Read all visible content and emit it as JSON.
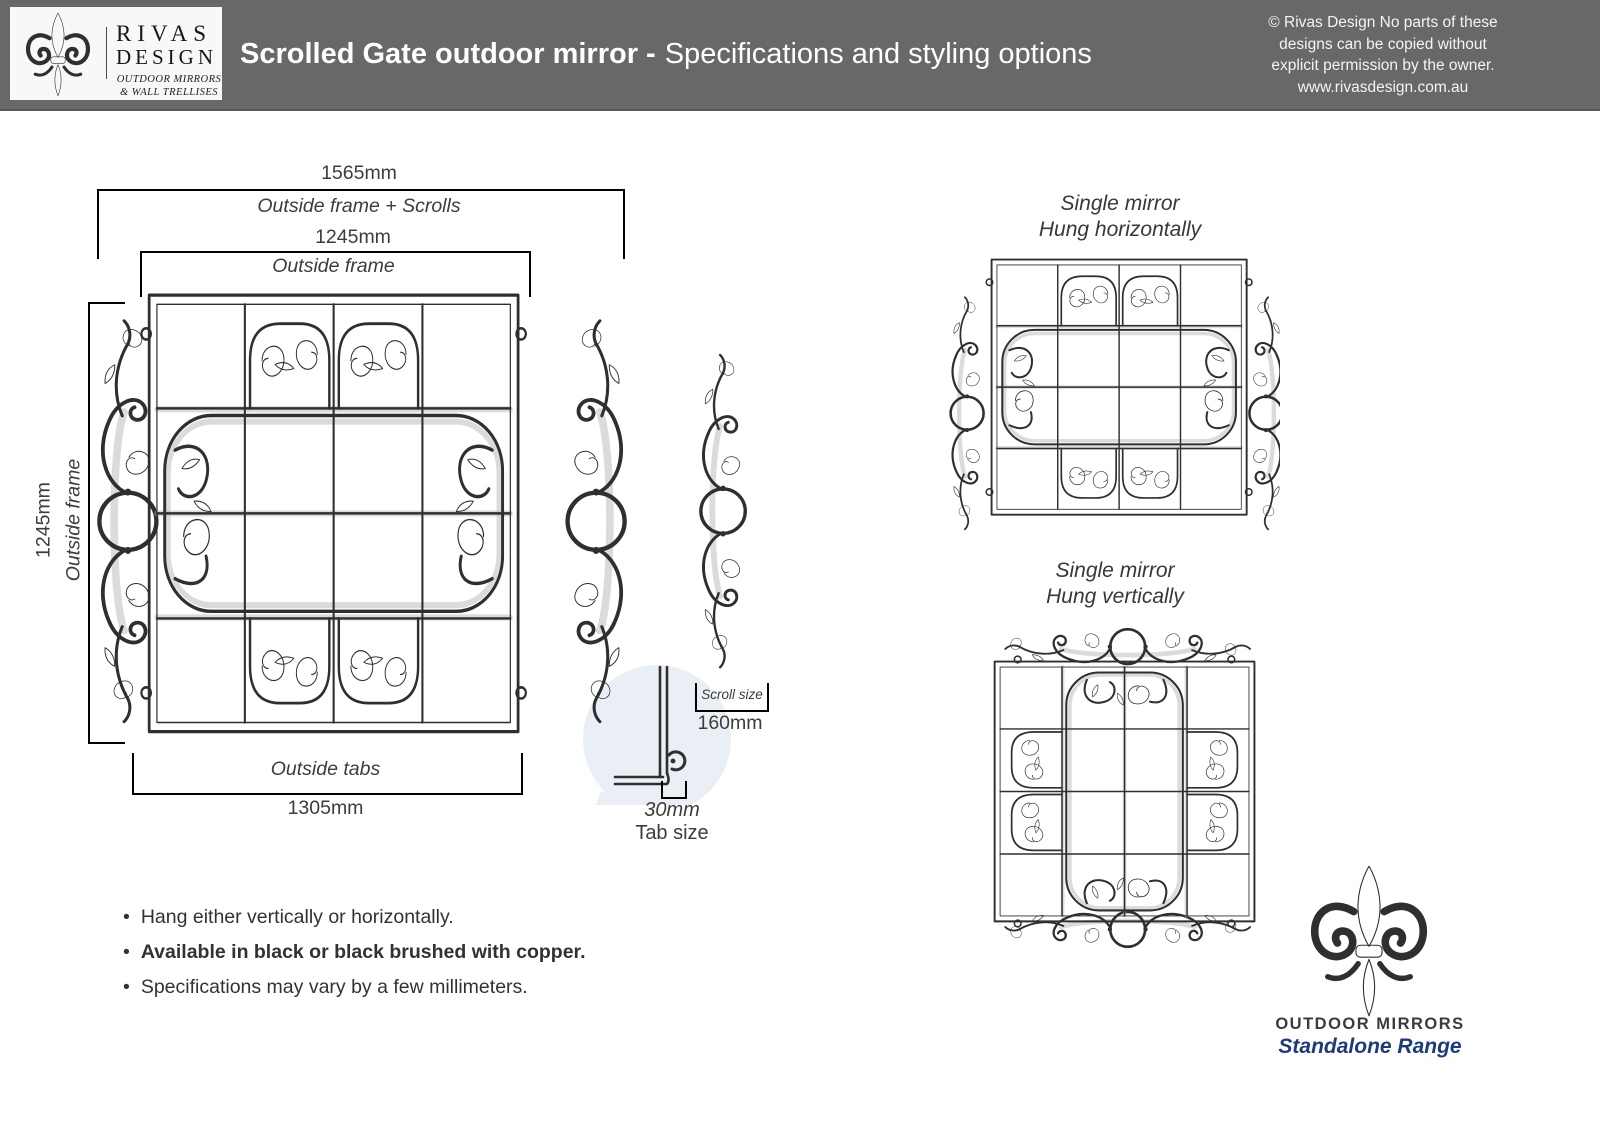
{
  "header": {
    "logo": {
      "brand_line1": "RIVAS",
      "brand_line2": "DESIGN",
      "tagline_line1": "OUTDOOR MIRRORS",
      "tagline_line2": "& WALL TRELLISES"
    },
    "title_bold": "Scrolled Gate outdoor mirror -",
    "title_regular": "Specifications and styling options",
    "copyright_lines": [
      "© Rivas Design No parts of these",
      "designs can be copied without",
      "explicit permission by the owner.",
      "www.rivasdesign.com.au"
    ]
  },
  "main_diagram": {
    "dim_outside_frame_scrolls": {
      "value": "1565mm",
      "label": "Outside frame + Scrolls"
    },
    "dim_outside_frame_top": {
      "value": "1245mm",
      "label": "Outside frame"
    },
    "dim_outside_frame_left": {
      "value": "1245mm",
      "label": "Outside frame"
    },
    "dim_outside_tabs": {
      "label": "Outside tabs",
      "value": "1305mm"
    },
    "scroll_detail": {
      "label": "Scroll size",
      "value": "160mm"
    },
    "tab_detail": {
      "value": "30mm",
      "label": "Tab size"
    }
  },
  "variants": [
    {
      "title_line1": "Single mirror",
      "title_line2": "Hung horizontally"
    },
    {
      "title_line1": "Single mirror",
      "title_line2": "Hung vertically"
    }
  ],
  "notes": [
    {
      "text": "Hang either vertically or horizontally.",
      "bold": false
    },
    {
      "text": "Available in black or black brushed with copper.",
      "bold": true
    },
    {
      "text": "Specifications may vary by a few millimeters.",
      "bold": false
    }
  ],
  "footer_logo": {
    "line1": "OUTDOOR MIRRORS",
    "line2": "Standalone Range"
  },
  "colors": {
    "header_gray": "#686868",
    "accent_orange": "#c8882f",
    "accent_green": "#76a33b",
    "sketch_ink": "#2f2f2f",
    "navy": "#1d3c77",
    "watermark_gray": "#c8c8cc",
    "bubble_blue": "#eaeff6"
  }
}
